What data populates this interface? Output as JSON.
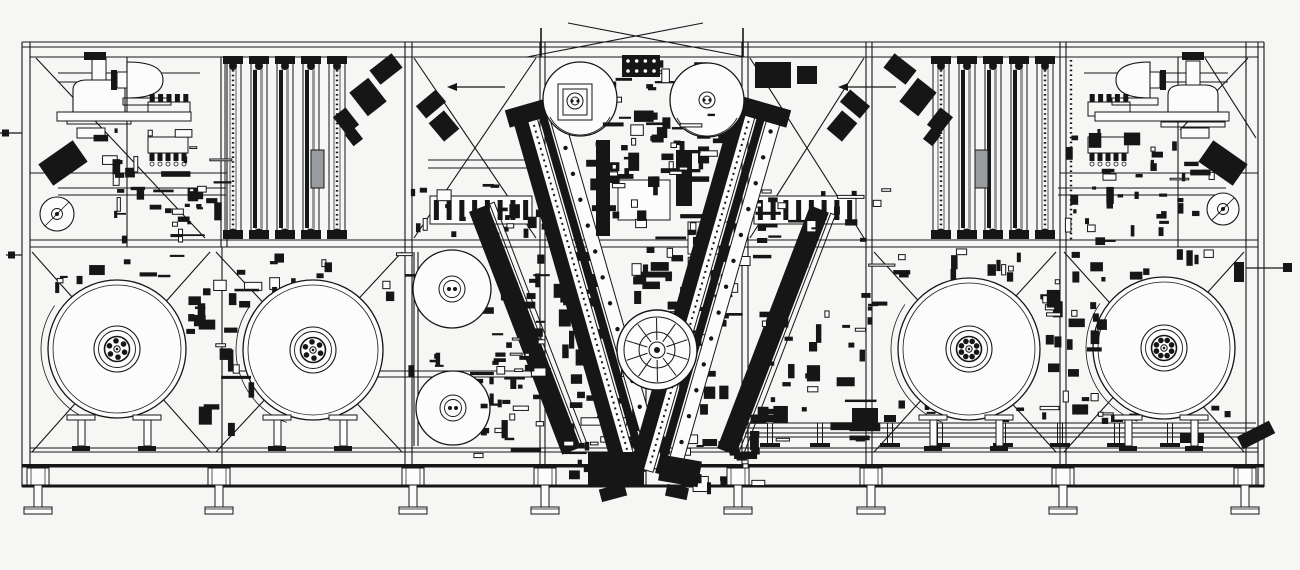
{
  "meta": {
    "drawing_kind": "machine-assembly-front-elevation",
    "colors": {
      "background": "#f6f6f5",
      "ink": "#161616",
      "paper": "#fcfcfc",
      "gray": "#989c9e"
    },
    "seed": 7,
    "canvas": {
      "width": 1300,
      "height": 570
    }
  },
  "frame": {
    "verticals": [
      [
        22,
        42,
        487
      ],
      [
        30,
        42,
        487
      ],
      [
        127,
        57,
        247
      ],
      [
        221,
        57,
        247
      ],
      [
        227,
        57,
        247
      ],
      [
        405,
        42,
        487
      ],
      [
        412,
        42,
        487
      ],
      [
        540,
        42,
        487
      ],
      [
        545,
        42,
        487
      ],
      [
        742,
        42,
        487
      ],
      [
        748,
        42,
        487
      ],
      [
        866,
        42,
        487
      ],
      [
        872,
        42,
        487
      ],
      [
        1060,
        42,
        487
      ],
      [
        1066,
        42,
        487
      ],
      [
        1178,
        57,
        247
      ],
      [
        1246,
        42,
        487
      ],
      [
        1258,
        42,
        487
      ],
      [
        1264,
        42,
        487
      ],
      [
        222,
        247,
        487
      ],
      [
        636,
        388,
        487
      ],
      [
        646,
        388,
        487
      ],
      [
        414,
        252,
        446
      ],
      [
        418,
        252,
        446
      ]
    ],
    "horizontals": [
      [
        42,
        22,
        1264
      ],
      [
        47,
        22,
        1264
      ],
      [
        57,
        30,
        1258
      ],
      [
        240,
        30,
        1258
      ],
      [
        247,
        30,
        1258
      ],
      [
        448,
        30,
        1258
      ],
      [
        452,
        30,
        1258
      ],
      [
        188,
        58,
        226
      ],
      [
        195,
        58,
        226
      ],
      [
        188,
        1058,
        1226
      ],
      [
        195,
        1058,
        1226
      ],
      [
        371,
        232,
        538
      ],
      [
        377,
        232,
        538
      ],
      [
        73,
        58,
        200
      ],
      [
        82,
        58,
        162
      ],
      [
        73,
        1084,
        1228
      ],
      [
        82,
        1124,
        1228
      ],
      [
        160,
        428,
        542
      ],
      [
        168,
        428,
        542
      ],
      [
        173,
        30,
        227
      ],
      [
        173,
        1060,
        1258
      ]
    ],
    "bands": [
      [
        22,
        464,
        1242,
        3.5
      ],
      [
        22,
        484.5,
        1242,
        3
      ]
    ],
    "braces": [
      [
        36,
        58,
        205,
        238
      ],
      [
        414,
        58,
        536,
        238
      ],
      [
        414,
        238,
        536,
        58
      ],
      [
        750,
        58,
        864,
        238
      ],
      [
        750,
        238,
        864,
        58
      ],
      [
        1205,
        58,
        1256,
        138
      ],
      [
        1248,
        58,
        1180,
        130
      ],
      [
        32,
        452,
        210,
        252
      ],
      [
        32,
        252,
        210,
        452
      ],
      [
        216,
        452,
        402,
        252
      ],
      [
        216,
        252,
        402,
        452
      ],
      [
        874,
        452,
        1056,
        252
      ],
      [
        874,
        252,
        1056,
        452
      ],
      [
        1064,
        452,
        1244,
        252
      ],
      [
        1064,
        252,
        1244,
        452
      ]
    ],
    "gable": {
      "lines": [
        [
          527,
          57,
          703,
          23
        ],
        [
          568,
          23,
          745,
          57
        ]
      ],
      "stubs": [
        [
          541,
          28,
          57
        ],
        [
          743,
          28,
          57
        ]
      ]
    }
  },
  "feet": {
    "xs": [
      38,
      219,
      413,
      545,
      738,
      871,
      1063,
      1245
    ],
    "block": {
      "y": 468,
      "w": 22,
      "h": 17
    },
    "stem": {
      "y": 485,
      "w": 8,
      "h": 22
    },
    "pad": {
      "y": 507,
      "w": 28,
      "h": 7
    }
  },
  "tracks": {
    "left": {
      "centers": [
        233,
        259,
        285,
        311,
        337
      ],
      "top": 62,
      "bottom": 236,
      "width": 16,
      "chain_idx": [
        0,
        4
      ]
    },
    "right": {
      "centers": [
        941,
        967,
        993,
        1019,
        1045
      ],
      "top": 62,
      "bottom": 236,
      "width": 16,
      "chain_idx": [
        0,
        4
      ]
    },
    "gray_blocks": [
      [
        311,
        150,
        13,
        38
      ],
      [
        975,
        150,
        13,
        38
      ]
    ],
    "chains_extra": [
      [
        1071,
        60,
        240
      ]
    ]
  },
  "hoppers": {
    "bells": [
      {
        "cx": 99,
        "base": 112,
        "w": 52,
        "h": 32,
        "neck_h": 22
      },
      {
        "cx": 1193,
        "base": 115,
        "w": 50,
        "h": 30,
        "neck_h": 24
      }
    ],
    "side_bells": [
      {
        "flat_x": 127,
        "depth": 36,
        "cy": 80,
        "half": 18,
        "dir": 1
      },
      {
        "flat_x": 1150,
        "depth": 34,
        "cy": 80,
        "half": 18,
        "dir": -1
      }
    ]
  },
  "combs": [
    {
      "x": 148,
      "y": 102,
      "w": 42,
      "h": 14,
      "teeth": 5,
      "dir": "up",
      "dots": false
    },
    {
      "x": 148,
      "y": 137,
      "w": 40,
      "h": 16,
      "teeth": 5,
      "dir": "down",
      "dots": true
    },
    {
      "x": 1088,
      "y": 102,
      "w": 42,
      "h": 14,
      "teeth": 5,
      "dir": "up",
      "dots": false
    },
    {
      "x": 1088,
      "y": 137,
      "w": 40,
      "h": 16,
      "teeth": 5,
      "dir": "down",
      "dots": true
    }
  ],
  "boxes": [
    {
      "x": 57,
      "y": 112,
      "w": 134,
      "h": 9
    },
    {
      "x": 1095,
      "y": 112,
      "w": 134,
      "h": 9
    },
    {
      "x": 77,
      "y": 128,
      "w": 28,
      "h": 10
    },
    {
      "x": 1181,
      "y": 128,
      "w": 28,
      "h": 10
    },
    {
      "x": 430,
      "y": 196,
      "w": 102,
      "h": 28,
      "teeth": 8
    },
    {
      "x": 754,
      "y": 196,
      "w": 102,
      "h": 28,
      "teeth": 8
    },
    {
      "x": 618,
      "y": 180,
      "w": 52,
      "h": 40
    },
    {
      "x": 688,
      "y": 222,
      "w": 46,
      "h": 32
    }
  ],
  "blocks": [
    [
      42,
      150,
      42,
      26,
      -35
    ],
    [
      372,
      60,
      28,
      18,
      -38
    ],
    [
      356,
      82,
      24,
      30,
      -38
    ],
    [
      338,
      110,
      16,
      22,
      -38
    ],
    [
      348,
      130,
      12,
      14,
      -38
    ],
    [
      418,
      96,
      26,
      16,
      -40
    ],
    [
      434,
      114,
      20,
      24,
      -40
    ],
    [
      1202,
      150,
      42,
      26,
      35
    ],
    [
      886,
      60,
      28,
      18,
      38
    ],
    [
      906,
      82,
      24,
      30,
      38
    ],
    [
      932,
      110,
      16,
      22,
      38
    ],
    [
      926,
      130,
      12,
      14,
      38
    ],
    [
      842,
      96,
      26,
      16,
      40
    ],
    [
      832,
      114,
      20,
      24,
      40
    ],
    [
      755,
      62,
      36,
      26,
      0
    ],
    [
      797,
      66,
      20,
      18,
      0
    ],
    [
      596,
      140,
      14,
      96,
      0
    ],
    [
      676,
      150,
      16,
      56,
      0
    ],
    [
      588,
      452,
      56,
      34,
      0
    ],
    [
      660,
      458,
      40,
      26,
      10
    ],
    [
      600,
      486,
      26,
      13,
      -15
    ],
    [
      666,
      486,
      22,
      12,
      12
    ],
    [
      1238,
      428,
      36,
      14,
      -27
    ],
    [
      1180,
      433,
      24,
      10,
      0
    ],
    [
      852,
      408,
      26,
      18,
      0
    ],
    [
      84,
      52,
      22,
      8,
      0
    ],
    [
      1182,
      52,
      22,
      8,
      0
    ]
  ],
  "dotted_block": {
    "x": 622,
    "y": 55,
    "w": 38,
    "h": 22,
    "rows": 2,
    "cols": 4
  },
  "v_arms": {
    "main": [
      {
        "cx": 590,
        "cy": 295,
        "len": 370,
        "angle": -16
      },
      {
        "cx": 706,
        "cy": 295,
        "len": 370,
        "angle": 16
      }
    ],
    "outer": [
      {
        "cx": 524,
        "cy": 330,
        "len": 260,
        "angle": -21
      },
      {
        "cx": 772,
        "cy": 330,
        "len": 260,
        "angle": 21
      }
    ]
  },
  "turret": {
    "cx": 657,
    "cy": 350,
    "r": 40,
    "spokes": 10
  },
  "reels": [
    {
      "cx": 117,
      "cy": 349,
      "r": 69,
      "bolts": 6
    },
    {
      "cx": 313,
      "cy": 350,
      "r": 70,
      "bolts": 6
    },
    {
      "cx": 969,
      "cy": 349,
      "r": 71,
      "bolts": 8
    },
    {
      "cx": 1164,
      "cy": 348,
      "r": 71,
      "bolts": 8
    }
  ],
  "mid_rolls": [
    {
      "cx": 452,
      "cy": 289,
      "r": 39
    },
    {
      "cx": 453,
      "cy": 408,
      "r": 37
    }
  ],
  "top_rolls": [
    {
      "cx": 580,
      "cy": 99,
      "r": 37,
      "bracket": true
    },
    {
      "cx": 707,
      "cy": 100,
      "r": 37,
      "bracket": false
    }
  ],
  "small_rolls": [
    {
      "cx": 57,
      "cy": 214,
      "r": 17
    },
    {
      "cx": 1223,
      "cy": 209,
      "r": 16
    }
  ],
  "conveyor": {
    "rail_ys": [
      423,
      428,
      433,
      437
    ],
    "x1": 745,
    "x2": 1256,
    "hangers": [
      770,
      820,
      890,
      940,
      1003,
      1060,
      1117,
      1170
    ]
  },
  "pointers": {
    "arrows": [
      {
        "tip_x": 447,
        "y": 87,
        "len": 48
      },
      {
        "tip_x": 838,
        "y": 87,
        "len": 48
      }
    ],
    "right_rod": {
      "y": 268,
      "x1": 1246,
      "x2": 1283,
      "box": [
        1283,
        263,
        9,
        9
      ],
      "mech": [
        1234,
        262,
        10,
        20
      ]
    },
    "left_stubs": [
      {
        "y": 133,
        "x1": 0,
        "x2": 22
      },
      {
        "y": 255,
        "x1": 6,
        "x2": 22
      }
    ]
  },
  "clusters_pre": [
    {
      "x": 92,
      "y": 128,
      "w": 132,
      "h": 110,
      "n": 42,
      "min": 3,
      "max": 20
    },
    {
      "x": 55,
      "y": 250,
      "w": 350,
      "h": 45,
      "n": 26,
      "min": 4,
      "max": 18
    },
    {
      "x": 586,
      "y": 60,
      "w": 134,
      "h": 122,
      "n": 46,
      "min": 4,
      "max": 22
    },
    {
      "x": 562,
      "y": 198,
      "w": 196,
      "h": 274,
      "n": 100,
      "min": 5,
      "max": 30
    },
    {
      "x": 468,
      "y": 252,
      "w": 104,
      "h": 204,
      "n": 40,
      "min": 4,
      "max": 22
    },
    {
      "x": 752,
      "y": 250,
      "w": 126,
      "h": 196,
      "n": 40,
      "min": 4,
      "max": 22
    },
    {
      "x": 1062,
      "y": 128,
      "w": 150,
      "h": 112,
      "n": 42,
      "min": 3,
      "max": 20
    },
    {
      "x": 876,
      "y": 248,
      "w": 336,
      "h": 34,
      "n": 24,
      "min": 4,
      "max": 18
    },
    {
      "x": 406,
      "y": 182,
      "w": 142,
      "h": 62,
      "n": 20,
      "min": 4,
      "max": 16
    },
    {
      "x": 744,
      "y": 182,
      "w": 142,
      "h": 62,
      "n": 20,
      "min": 4,
      "max": 16
    },
    {
      "x": 574,
      "y": 428,
      "w": 182,
      "h": 56,
      "n": 30,
      "min": 4,
      "max": 20
    },
    {
      "x": 886,
      "y": 396,
      "w": 340,
      "h": 26,
      "n": 18,
      "min": 4,
      "max": 14
    },
    {
      "x": 235,
      "y": 352,
      "w": 300,
      "h": 24,
      "n": 14,
      "min": 4,
      "max": 14
    }
  ],
  "clusters_post": [
    {
      "x": 186,
      "y": 286,
      "w": 64,
      "h": 138,
      "n": 22,
      "min": 5,
      "max": 20
    },
    {
      "x": 1038,
      "y": 286,
      "w": 64,
      "h": 138,
      "n": 22,
      "min": 5,
      "max": 20
    },
    {
      "x": 596,
      "y": 112,
      "w": 120,
      "h": 72,
      "n": 22,
      "min": 4,
      "max": 16
    },
    {
      "x": 480,
      "y": 270,
      "w": 60,
      "h": 160,
      "n": 18,
      "min": 4,
      "max": 14
    }
  ]
}
